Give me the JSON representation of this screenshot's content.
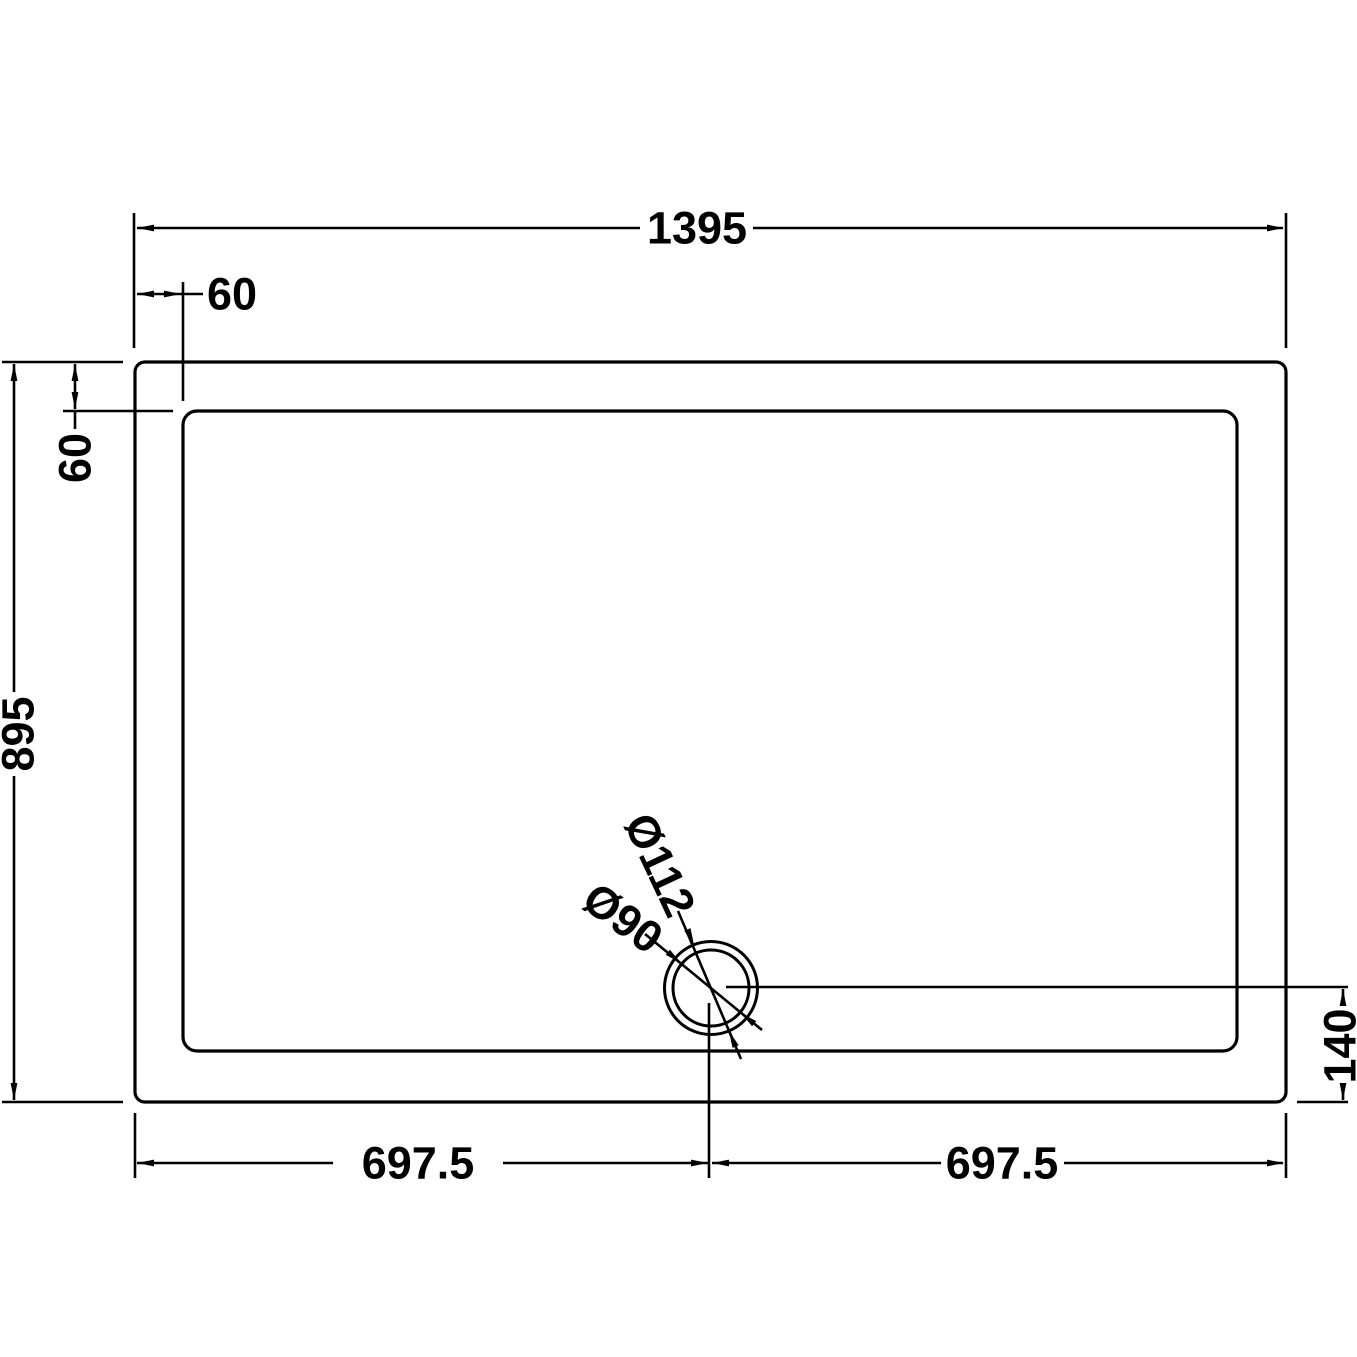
{
  "drawing": {
    "subject": "rectangular shower tray plan view with offset waste drain",
    "background_color": "#ffffff",
    "line_color": "#000000",
    "labels": {
      "overall_width": "1395",
      "top_edge_offset": "60",
      "left_edge_offset": "60",
      "overall_depth": "895",
      "drain_center_from_bottom": "140",
      "bottom_left_half": "697.5",
      "bottom_right_half": "697.5",
      "drain_outer_diameter": "Ø112",
      "drain_inner_diameter": "Ø90"
    }
  }
}
